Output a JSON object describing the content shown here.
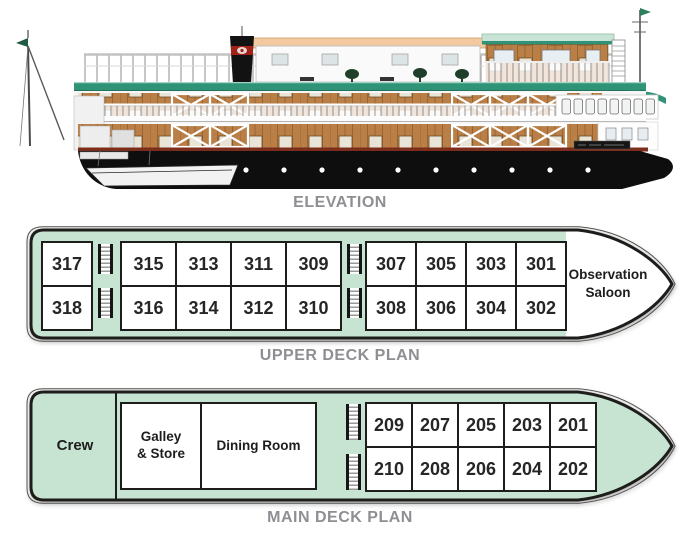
{
  "colors": {
    "deck-green": "#c7e3d2",
    "outline": "#1d1d1b",
    "thin-outline": "#55524e",
    "label-gray": "#8e8e93",
    "wood": "#b97f46",
    "roof-green": "#2f9377",
    "roof-mint": "#c9e4d6",
    "hull-black": "#0e0e0e",
    "hull-stripe": "#7c2d1c",
    "awning-peach": "#f2c9a0",
    "funnel-red": "#a32218"
  },
  "elevation": {
    "label": "ELEVATION"
  },
  "upper_deck": {
    "label": "UPPER DECK PLAN",
    "observation_saloon": "Observation\nSaloon",
    "single_column": [
      "317",
      "318"
    ],
    "block_a_columns": [
      [
        "315",
        "316"
      ],
      [
        "313",
        "314"
      ],
      [
        "311",
        "312"
      ],
      [
        "309",
        "310"
      ]
    ],
    "block_b_columns": [
      [
        "307",
        "308"
      ],
      [
        "305",
        "306"
      ],
      [
        "303",
        "304"
      ],
      [
        "301",
        "302"
      ]
    ]
  },
  "main_deck": {
    "label": "MAIN DECK PLAN",
    "crew_label": "Crew",
    "galley_label": "Galley\n& Store",
    "dining_label": "Dining Room",
    "columns": [
      [
        "209",
        "210"
      ],
      [
        "207",
        "208"
      ],
      [
        "205",
        "206"
      ],
      [
        "203",
        "204"
      ],
      [
        "201",
        "202"
      ]
    ]
  }
}
